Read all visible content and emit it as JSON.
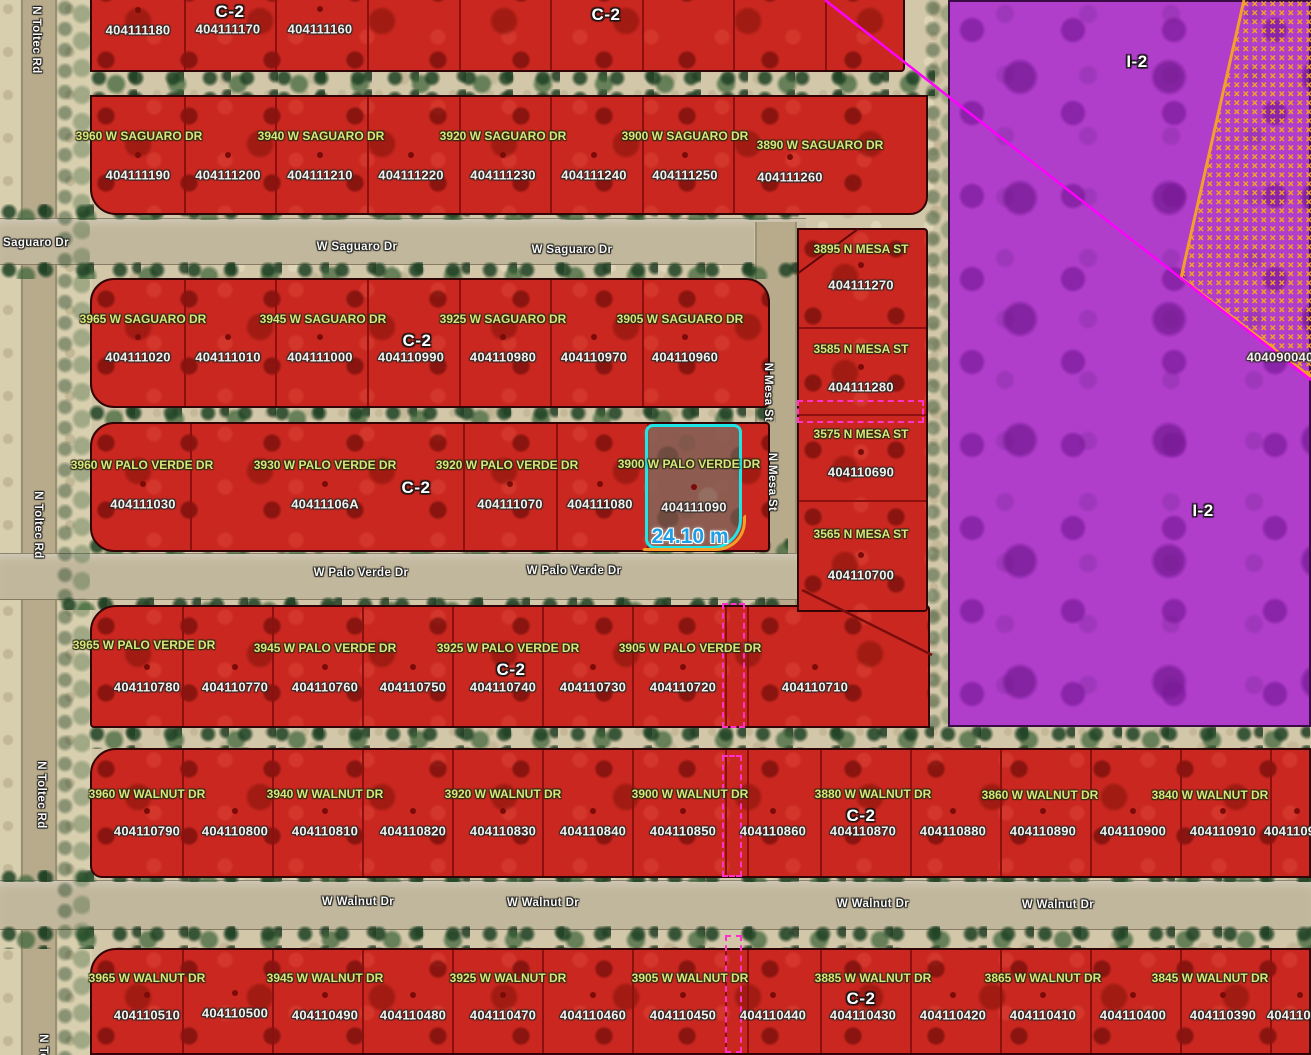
{
  "map": {
    "palette": {
      "c2_fill": "#c9271f",
      "i2_fill": "#b03ecb",
      "sand": "#d2c7a8",
      "road": "#c1b79c",
      "address_text": "#d9e679",
      "parcel_text": "#f2efec",
      "street_text": "#f8f8f5",
      "zone_text": "#ffffff",
      "selection_pink": "#ff31c9",
      "highlight_cyan": "#1ce6e6",
      "measure_blue": "#1d9fe8",
      "boundary_orange": "#f2a028",
      "line_magenta": "#ff00ff",
      "parcel_border": "#8c1010",
      "vegetation_green": "#2e5a33"
    },
    "roads": [
      {
        "name": "toltec-road-shoulder",
        "kind": "shoulder",
        "x": 0,
        "y": 0,
        "w": 92,
        "h": 1055
      },
      {
        "name": "toltec-road",
        "kind": "road-v",
        "x": 20,
        "y": 0,
        "w": 38,
        "h": 1055
      },
      {
        "name": "saguaro-street",
        "kind": "road-h",
        "x": 0,
        "y": 218,
        "w": 806,
        "h": 47
      },
      {
        "name": "mesa-street",
        "kind": "road-v",
        "x": 754,
        "y": 222,
        "w": 44,
        "h": 392
      },
      {
        "name": "palo-verde-street",
        "kind": "road-h",
        "x": 0,
        "y": 553,
        "w": 810,
        "h": 47
      },
      {
        "name": "walnut-street",
        "kind": "road-h",
        "x": 0,
        "y": 880,
        "w": 1311,
        "h": 50
      }
    ],
    "vegetation": [
      {
        "x": 90,
        "y": 70,
        "w": 845,
        "h": 26
      },
      {
        "x": 0,
        "y": 204,
        "w": 808,
        "h": 16
      },
      {
        "x": 0,
        "y": 262,
        "w": 808,
        "h": 17
      },
      {
        "x": 88,
        "y": 405,
        "w": 688,
        "h": 18
      },
      {
        "x": 88,
        "y": 538,
        "w": 700,
        "h": 16
      },
      {
        "x": 60,
        "y": 597,
        "w": 748,
        "h": 13
      },
      {
        "x": 88,
        "y": 726,
        "w": 1223,
        "h": 23
      },
      {
        "x": 0,
        "y": 870,
        "w": 1311,
        "h": 12
      },
      {
        "x": 0,
        "y": 926,
        "w": 1311,
        "h": 23
      },
      {
        "x": 56,
        "y": 0,
        "w": 34,
        "h": 1055,
        "light": true
      },
      {
        "x": 924,
        "y": 0,
        "w": 26,
        "h": 732,
        "light": true
      }
    ],
    "zones": {
      "i2_zone": {
        "x": 948,
        "y": 0,
        "w": 363,
        "h": 727
      }
    },
    "blocks": [
      {
        "name": "block-top",
        "x": 90,
        "y": -28,
        "w": 815,
        "h": 100,
        "r": "0 0 4px 0",
        "dx": [
          182,
          273,
          365,
          457,
          548,
          640,
          731,
          823
        ]
      },
      {
        "name": "block-saguaro-north",
        "x": 90,
        "y": 95,
        "w": 838,
        "h": 120,
        "r": "0 0 18px 26px",
        "dx": [
          182,
          273,
          365,
          457,
          548,
          640,
          731
        ]
      },
      {
        "name": "block-saguaro-south",
        "x": 90,
        "y": 278,
        "w": 680,
        "h": 130,
        "r": "24px 24px 6px 24px",
        "dx": [
          182,
          273,
          365,
          457,
          548,
          640
        ]
      },
      {
        "name": "block-palo-verde-north",
        "x": 90,
        "y": 422,
        "w": 680,
        "h": 130,
        "r": "24px 4px 4px 24px",
        "dx": [
          188,
          461,
          554,
          645
        ]
      },
      {
        "name": "block-palo-verde-south",
        "x": 90,
        "y": 605,
        "w": 840,
        "h": 123,
        "r": "26px 4px 0 4px",
        "dx": [
          180,
          270,
          360,
          450,
          540,
          630,
          723,
          745
        ]
      },
      {
        "name": "block-walnut-north",
        "x": 90,
        "y": 748,
        "w": 1221,
        "h": 130,
        "r": "26px 0 0 12px",
        "dx": [
          180,
          270,
          360,
          450,
          540,
          630,
          723,
          745,
          818,
          908,
          998,
          1088,
          1178,
          1268
        ]
      },
      {
        "name": "block-walnut-south",
        "x": 90,
        "y": 948,
        "w": 1221,
        "h": 107,
        "r": "26px 0 0 0",
        "dx": [
          180,
          270,
          360,
          450,
          540,
          630,
          723,
          745,
          818,
          908,
          998,
          1088,
          1178,
          1268
        ]
      },
      {
        "name": "block-mesa-column",
        "x": 797,
        "y": 228,
        "w": 131,
        "h": 384,
        "r": "0 4px 4px 0",
        "dy": [
          325,
          412,
          498
        ]
      }
    ],
    "parcels": [
      {
        "apn": "404111180",
        "x": 138,
        "y": 30
      },
      {
        "apn": "404111170",
        "x": 228,
        "y": 29,
        "dot": false
      },
      {
        "apn": "404111160",
        "x": 320,
        "y": 29
      },
      {
        "apn": "404111190",
        "x": 138,
        "y": 175
      },
      {
        "apn": "404111200",
        "x": 228,
        "y": 175
      },
      {
        "apn": "404111210",
        "x": 320,
        "y": 175
      },
      {
        "apn": "404111220",
        "x": 411,
        "y": 175
      },
      {
        "apn": "404111230",
        "x": 503,
        "y": 175
      },
      {
        "apn": "404111240",
        "x": 594,
        "y": 175
      },
      {
        "apn": "404111250",
        "x": 685,
        "y": 175
      },
      {
        "apn": "404111260",
        "x": 790,
        "y": 177
      },
      {
        "apn": "404111020",
        "x": 138,
        "y": 357
      },
      {
        "apn": "404111010",
        "x": 228,
        "y": 357
      },
      {
        "apn": "404111000",
        "x": 320,
        "y": 357
      },
      {
        "apn": "404110990",
        "x": 411,
        "y": 357,
        "dot": false
      },
      {
        "apn": "404110980",
        "x": 503,
        "y": 357
      },
      {
        "apn": "404110970",
        "x": 594,
        "y": 357
      },
      {
        "apn": "404110960",
        "x": 685,
        "y": 357
      },
      {
        "apn": "404111030",
        "x": 143,
        "y": 504
      },
      {
        "apn": "40411106A",
        "x": 325,
        "y": 504
      },
      {
        "apn": "404111070",
        "x": 510,
        "y": 504
      },
      {
        "apn": "404111080",
        "x": 600,
        "y": 504
      },
      {
        "apn": "404111090",
        "x": 694,
        "y": 507
      },
      {
        "apn": "404110780",
        "x": 147,
        "y": 687
      },
      {
        "apn": "404110770",
        "x": 235,
        "y": 687
      },
      {
        "apn": "404110760",
        "x": 325,
        "y": 687
      },
      {
        "apn": "404110750",
        "x": 413,
        "y": 687
      },
      {
        "apn": "404110740",
        "x": 503,
        "y": 687,
        "dot": false
      },
      {
        "apn": "404110730",
        "x": 593,
        "y": 687
      },
      {
        "apn": "404110720",
        "x": 683,
        "y": 687
      },
      {
        "apn": "404110710",
        "x": 815,
        "y": 687
      },
      {
        "apn": "404111270",
        "x": 861,
        "y": 285
      },
      {
        "apn": "404111280",
        "x": 861,
        "y": 387
      },
      {
        "apn": "404110690",
        "x": 861,
        "y": 472
      },
      {
        "apn": "404110700",
        "x": 861,
        "y": 575
      },
      {
        "apn": "404110790",
        "x": 147,
        "y": 831
      },
      {
        "apn": "404110800",
        "x": 235,
        "y": 831
      },
      {
        "apn": "404110810",
        "x": 325,
        "y": 831
      },
      {
        "apn": "404110820",
        "x": 413,
        "y": 831
      },
      {
        "apn": "404110830",
        "x": 503,
        "y": 831
      },
      {
        "apn": "404110840",
        "x": 593,
        "y": 831
      },
      {
        "apn": "404110850",
        "x": 683,
        "y": 831
      },
      {
        "apn": "404110860",
        "x": 773,
        "y": 831
      },
      {
        "apn": "404110870",
        "x": 863,
        "y": 831,
        "dot": false
      },
      {
        "apn": "404110880",
        "x": 953,
        "y": 831
      },
      {
        "apn": "404110890",
        "x": 1043,
        "y": 831
      },
      {
        "apn": "404110900",
        "x": 1133,
        "y": 831
      },
      {
        "apn": "404110910",
        "x": 1223,
        "y": 831
      },
      {
        "apn": "404110920",
        "x": 1297,
        "y": 831
      },
      {
        "apn": "404110510",
        "x": 147,
        "y": 1015
      },
      {
        "apn": "404110500",
        "x": 235,
        "y": 1013
      },
      {
        "apn": "404110490",
        "x": 325,
        "y": 1015
      },
      {
        "apn": "404110480",
        "x": 413,
        "y": 1015
      },
      {
        "apn": "404110470",
        "x": 503,
        "y": 1015
      },
      {
        "apn": "404110460",
        "x": 593,
        "y": 1015
      },
      {
        "apn": "404110450",
        "x": 683,
        "y": 1015
      },
      {
        "apn": "404110440",
        "x": 773,
        "y": 1015
      },
      {
        "apn": "404110430",
        "x": 863,
        "y": 1015,
        "dot": false
      },
      {
        "apn": "404110420",
        "x": 953,
        "y": 1015
      },
      {
        "apn": "404110410",
        "x": 1043,
        "y": 1015
      },
      {
        "apn": "404110400",
        "x": 1133,
        "y": 1015
      },
      {
        "apn": "404110390",
        "x": 1223,
        "y": 1015
      },
      {
        "apn": "404110380",
        "x": 1300,
        "y": 1015
      },
      {
        "apn": "404090040",
        "x": 1280,
        "y": 357,
        "dot": false
      }
    ],
    "addresses": [
      {
        "text": "3960 W SAGUARO DR",
        "x": 139,
        "y": 136
      },
      {
        "text": "3940 W SAGUARO DR",
        "x": 321,
        "y": 136
      },
      {
        "text": "3920 W SAGUARO DR",
        "x": 503,
        "y": 136
      },
      {
        "text": "3900 W SAGUARO DR",
        "x": 685,
        "y": 136
      },
      {
        "text": "3890 W SAGUARO DR",
        "x": 820,
        "y": 145
      },
      {
        "text": "3965 W SAGUARO DR",
        "x": 143,
        "y": 319
      },
      {
        "text": "3945 W SAGUARO DR",
        "x": 323,
        "y": 319
      },
      {
        "text": "3925 W SAGUARO DR",
        "x": 503,
        "y": 319
      },
      {
        "text": "3905 W SAGUARO DR",
        "x": 680,
        "y": 319
      },
      {
        "text": "3960 W PALO VERDE DR",
        "x": 142,
        "y": 465
      },
      {
        "text": "3930 W PALO VERDE DR",
        "x": 325,
        "y": 465
      },
      {
        "text": "3920 W PALO VERDE DR",
        "x": 507,
        "y": 465
      },
      {
        "text": "3900 W PALO VERDE DR",
        "x": 689,
        "y": 464
      },
      {
        "text": "3965 W PALO VERDE DR",
        "x": 144,
        "y": 645
      },
      {
        "text": "3945 W PALO VERDE DR",
        "x": 325,
        "y": 648
      },
      {
        "text": "3925 W PALO VERDE DR",
        "x": 508,
        "y": 648
      },
      {
        "text": "3905 W PALO VERDE DR",
        "x": 690,
        "y": 648
      },
      {
        "text": "3895 N MESA ST",
        "x": 861,
        "y": 249
      },
      {
        "text": "3585 N MESA ST",
        "x": 861,
        "y": 349
      },
      {
        "text": "3575 N MESA ST",
        "x": 861,
        "y": 434
      },
      {
        "text": "3565 N MESA ST",
        "x": 861,
        "y": 534
      },
      {
        "text": "3960 W WALNUT DR",
        "x": 147,
        "y": 794
      },
      {
        "text": "3940 W WALNUT DR",
        "x": 325,
        "y": 794
      },
      {
        "text": "3920 W WALNUT DR",
        "x": 503,
        "y": 794
      },
      {
        "text": "3900 W WALNUT DR",
        "x": 690,
        "y": 794
      },
      {
        "text": "3880 W WALNUT DR",
        "x": 873,
        "y": 794
      },
      {
        "text": "3860 W WALNUT DR",
        "x": 1040,
        "y": 795
      },
      {
        "text": "3840 W WALNUT DR",
        "x": 1210,
        "y": 795
      },
      {
        "text": "3965 W WALNUT DR",
        "x": 147,
        "y": 978
      },
      {
        "text": "3945 W WALNUT DR",
        "x": 325,
        "y": 978
      },
      {
        "text": "3925 W WALNUT DR",
        "x": 508,
        "y": 978
      },
      {
        "text": "3905 W WALNUT DR",
        "x": 690,
        "y": 978
      },
      {
        "text": "3885 W WALNUT DR",
        "x": 873,
        "y": 978
      },
      {
        "text": "3865 W WALNUT DR",
        "x": 1043,
        "y": 978
      },
      {
        "text": "3845 W WALNUT DR",
        "x": 1210,
        "y": 978
      }
    ],
    "zoning_labels": [
      {
        "text": "C-2",
        "x": 230,
        "y": 12
      },
      {
        "text": "C-2",
        "x": 606,
        "y": 15
      },
      {
        "text": "C-2",
        "x": 417,
        "y": 341
      },
      {
        "text": "C-2",
        "x": 416,
        "y": 488
      },
      {
        "text": "C-2",
        "x": 511,
        "y": 670
      },
      {
        "text": "C-2",
        "x": 861,
        "y": 816
      },
      {
        "text": "C-2",
        "x": 861,
        "y": 999
      },
      {
        "text": "I-2",
        "x": 1137,
        "y": 62
      },
      {
        "text": "I-2",
        "x": 1203,
        "y": 511
      }
    ],
    "street_labels": [
      {
        "text": "N Toltec Rd",
        "x": 36,
        "y": 40,
        "rot": 90
      },
      {
        "text": "Saguaro Dr",
        "x": 3,
        "y": 243,
        "align": "left"
      },
      {
        "text": "W Saguaro Dr",
        "x": 357,
        "y": 247
      },
      {
        "text": "W Saguaro Dr",
        "x": 572,
        "y": 250
      },
      {
        "text": "N Mesa St",
        "x": 768,
        "y": 392,
        "rot": 90
      },
      {
        "text": "N Mesa St",
        "x": 772,
        "y": 482,
        "rot": 90
      },
      {
        "text": "N Toltec Rd",
        "x": 38,
        "y": 525,
        "rot": 90
      },
      {
        "text": "W Palo Verde Dr",
        "x": 361,
        "y": 573
      },
      {
        "text": "W Palo Verde Dr",
        "x": 574,
        "y": 571
      },
      {
        "text": "N Toltec Rd",
        "x": 41,
        "y": 795,
        "rot": 90
      },
      {
        "text": "W Walnut Dr",
        "x": 358,
        "y": 902
      },
      {
        "text": "W Walnut Dr",
        "x": 543,
        "y": 903
      },
      {
        "text": "W Walnut Dr",
        "x": 873,
        "y": 904
      },
      {
        "text": "W Walnut Dr",
        "x": 1058,
        "y": 905
      },
      {
        "text": "N Toltec Rd",
        "x": 43,
        "y": 1068,
        "rot": 90
      }
    ],
    "selection_boxes": [
      {
        "x": 797,
        "y": 400,
        "w": 127,
        "h": 23
      },
      {
        "x": 722,
        "y": 603,
        "w": 23,
        "h": 125
      },
      {
        "x": 722,
        "y": 755,
        "w": 20,
        "h": 122
      },
      {
        "x": 725,
        "y": 935,
        "w": 17,
        "h": 118
      }
    ],
    "highlight": {
      "x": 645,
      "y": 424,
      "w": 97,
      "h": 125,
      "measurement": "24.10 m",
      "measurement_x": 690,
      "measurement_y": 537
    }
  }
}
